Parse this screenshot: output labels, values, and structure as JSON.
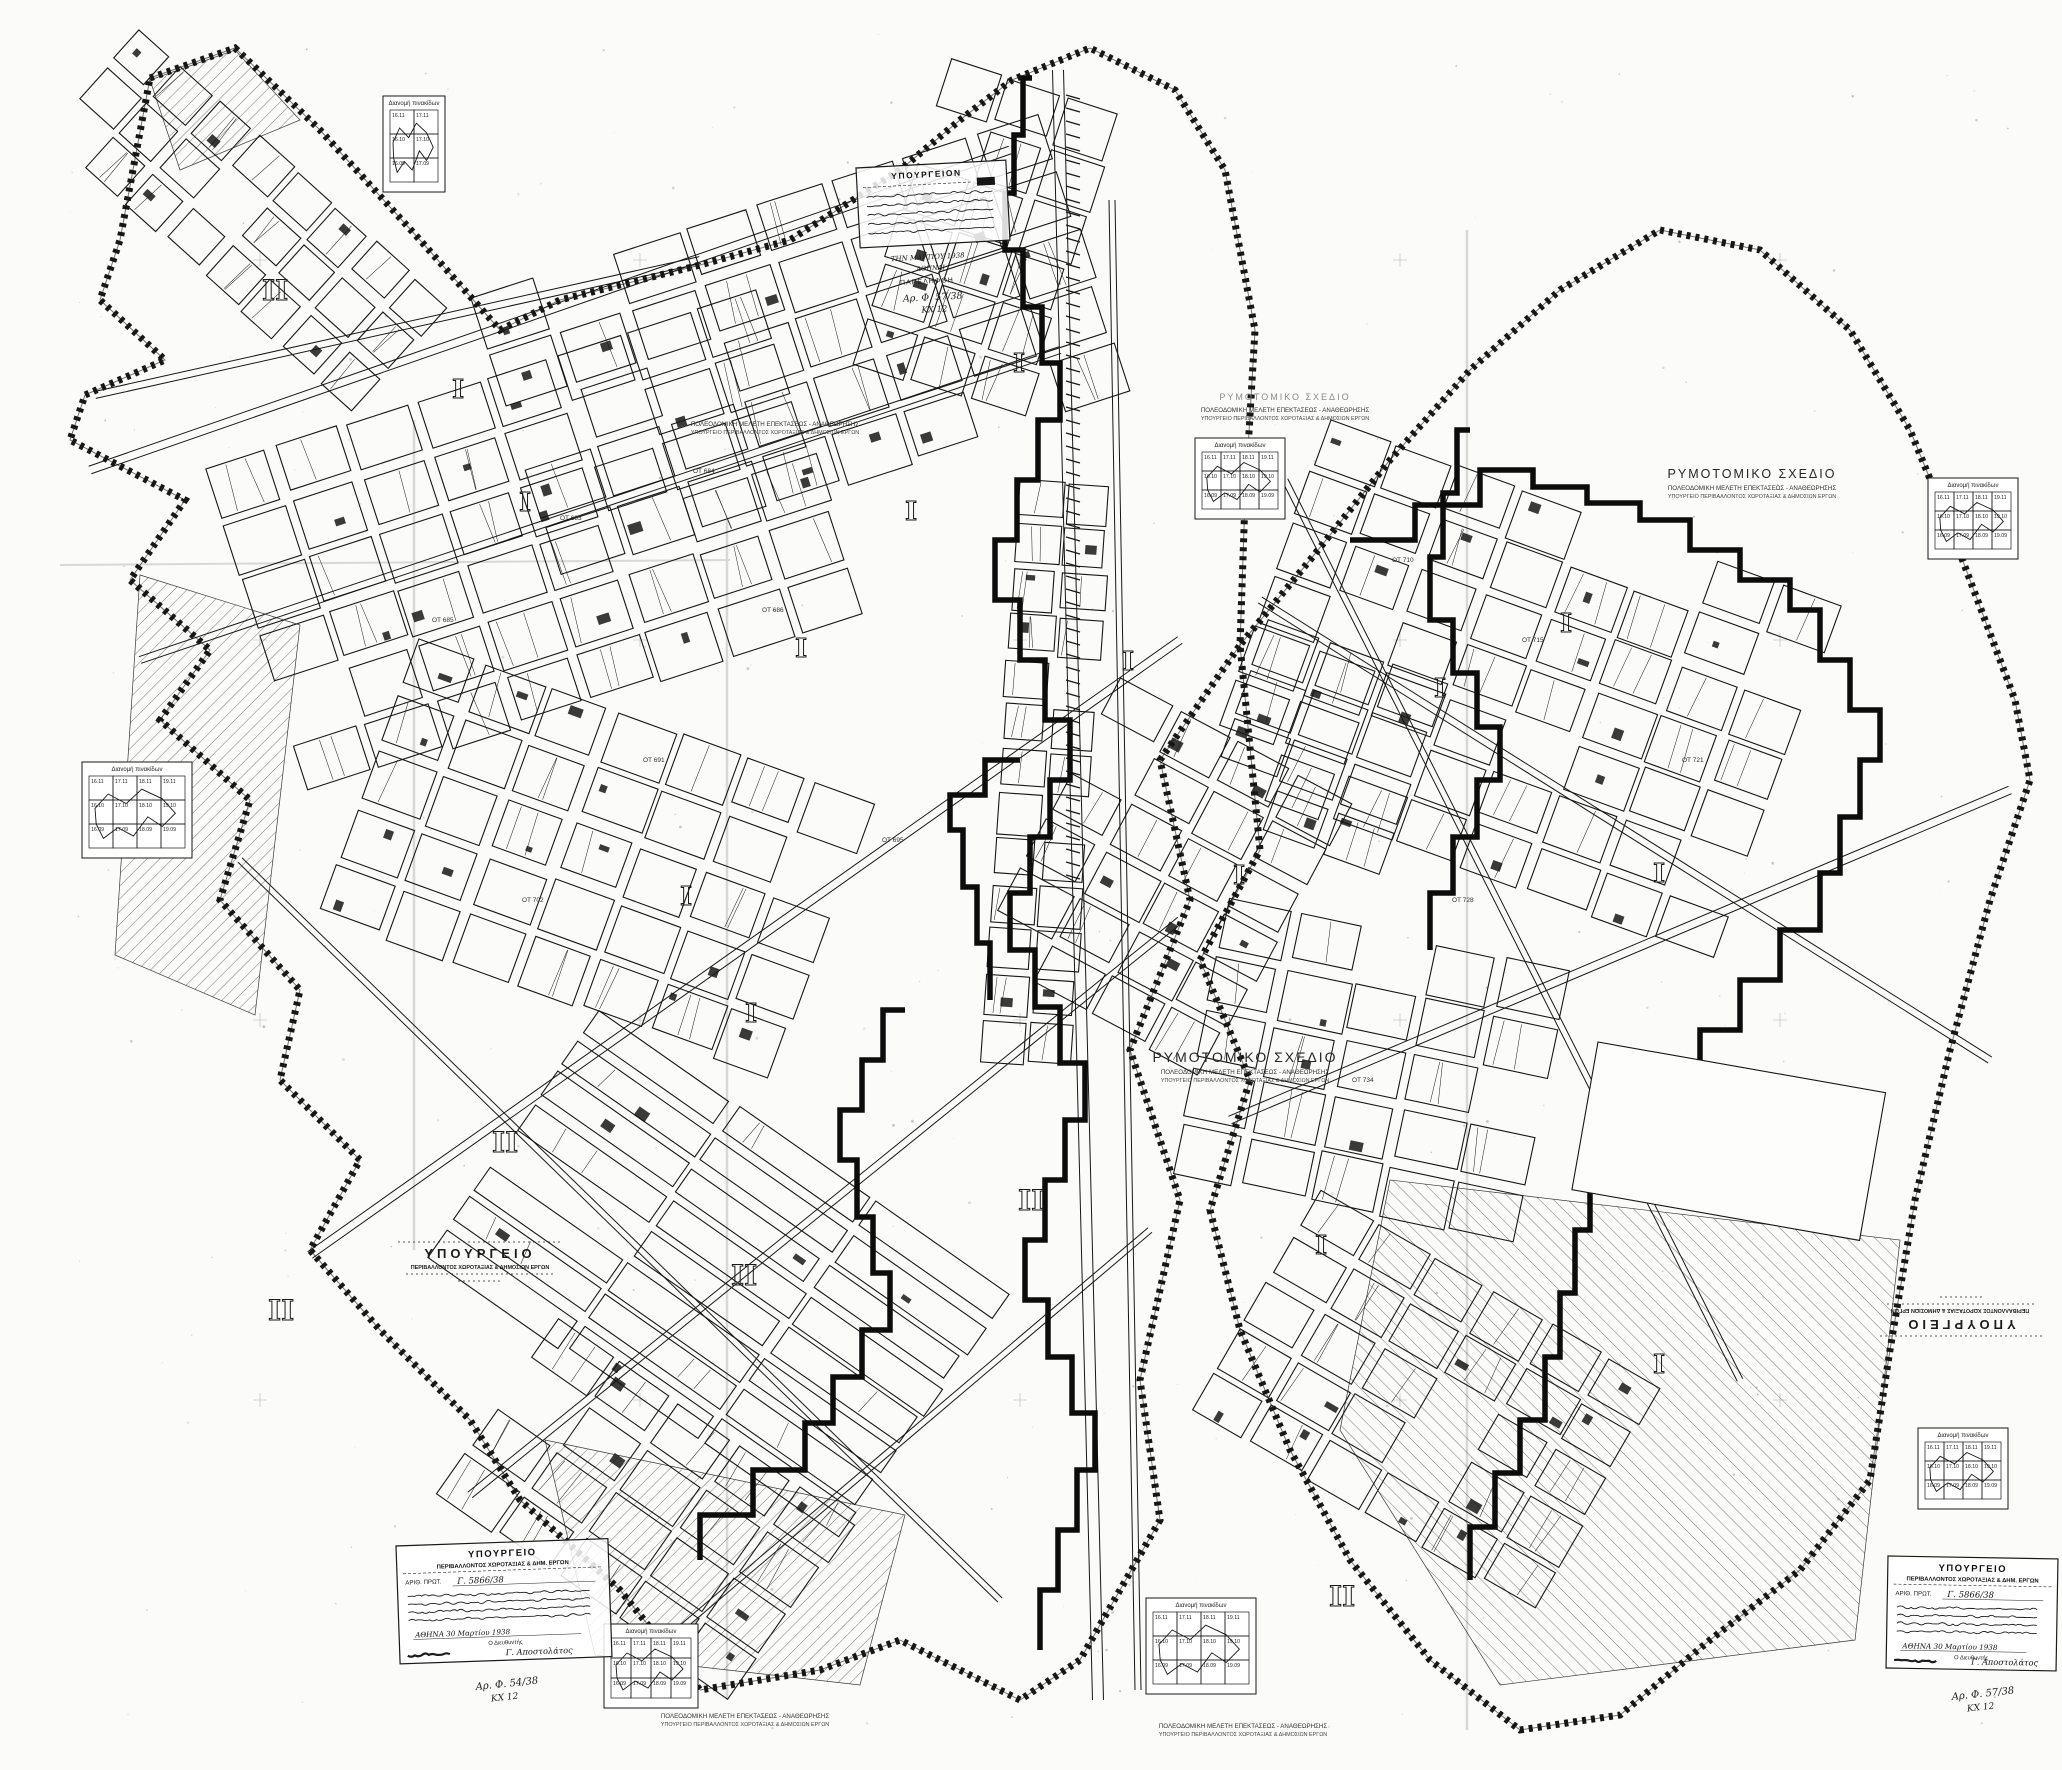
{
  "page": {
    "title": "ΡΥΜΟΤΟΜΙΚΟ ΣΧΕΔΙΟ"
  },
  "colors": {
    "ink": "#171717",
    "paper": "#fbfbfa",
    "faint_gray": "#9a9a9a",
    "seam_gray": "#d8d8d4"
  },
  "plan_labels": {
    "title": "ΡΥΜΟΤΟΜΙΚΟ ΣΧΕΔΙΟ",
    "subtitle1": "ΠΟΛΕΟΔΟΜΙΚΗ ΜΕΛΕΤΗ ΕΠΕΚΤΑΣΕΩΣ - ΑΝΑΘΕΩΡΗΣΗΣ",
    "subtitle2": "ΥΠΟΥΡΓΕΙΟ ΠΕΡΙΒΑΛΛΟΝΤΟΣ ΧΩΡΟΤΑΞΙΑΣ & ΔΗΜΟΣΙΩΝ ΕΡΓΩΝ"
  },
  "ministry_stamp": {
    "line1": "ΥΠΟΥΡΓΕΙΟ",
    "line2": "ΠΕΡΙΒΑΛΛΟΝΤΟΣ ΧΩΡΟΤΑΞΙΑΣ & ΔΗΜΟΣΙΩΝ ΕΡΓΩΝ"
  },
  "receipt_stamp": {
    "header": "ΥΠΟΥΡΓΕΙΟΝ",
    "received": "ΠΑΡΕΛΗΦΘΗ",
    "date": "ΤΗΝ ΜΑΡΤΙΟΥ 1938",
    "place": "ΑΘΗΝΑΙ"
  },
  "approval_stamp": {
    "header": "ΥΠΟΥΡΓΕΙΟ",
    "subheader": "ΠΕΡΙΒΑΛΛΟΝΤΟΣ ΧΩΡΟΤΑΞΙΑΣ & ΔΗΜ. ΕΡΓΩΝ",
    "act_label": "ΑΡΙΘ. ΠΡΩΤ.",
    "act_number": "Γ. 5866/38",
    "place_date": "ΑΘΗΝΑ 30 Μαρτίου 1938",
    "signer_label": "Ο Διευθυντής",
    "signature": "Γ. Αποστολάτος"
  },
  "file_notes": {
    "top": "Αρ. Φ. 57/38",
    "bottom_left": "Αρ. Φ. 54/38",
    "bottom_right": "Αρ. Φ. 57/38",
    "code": "ΚΧ 12"
  },
  "keymap": {
    "title": "Διανομή πινακίδων",
    "sheets": [
      "16.11",
      "17.11",
      "18.11",
      "19.11",
      "16.10",
      "17.10",
      "18.10",
      "19.10",
      "16.09",
      "17.09",
      "18.09",
      "19.09"
    ]
  },
  "sectors": {
    "one": "Ι",
    "two": "ΙΙ"
  },
  "blocks": [
    "ΟΤ 683",
    "ΟΤ 684",
    "ΟΤ 685",
    "ΟΤ 686",
    "ΟΤ 691",
    "ΟΤ 695",
    "ΟΤ 702",
    "ΟΤ 710",
    "ΟΤ 715",
    "ΟΤ 721",
    "ΟΤ 728",
    "ΟΤ 734"
  ]
}
